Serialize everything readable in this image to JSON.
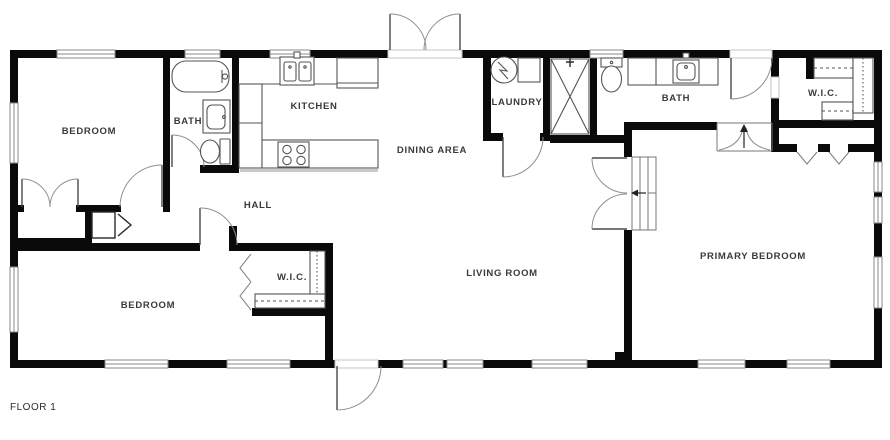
{
  "floor_label": "FLOOR 1",
  "rooms": {
    "bedroom_top_left": {
      "label": "BEDROOM"
    },
    "bath_left": {
      "label": "BATH"
    },
    "kitchen": {
      "label": "KITCHEN"
    },
    "dining": {
      "label": "DINING AREA"
    },
    "laundry": {
      "label": "LAUNDRY"
    },
    "bath_right": {
      "label": "BATH"
    },
    "wic_top_right": {
      "label": "W.I.C."
    },
    "hall": {
      "label": "HALL"
    },
    "bedroom_bottom_left": {
      "label": "BEDROOM"
    },
    "wic_bottom": {
      "label": "W.I.C."
    },
    "living_room": {
      "label": "LIVING ROOM"
    },
    "primary_bedroom": {
      "label": "PRIMARY BEDROOM"
    }
  },
  "fixtures": [
    "bathtub-icon",
    "vanity-sink-icon",
    "toilet-icon",
    "kitchen-sink-icon",
    "fridge-icon",
    "stove-icon",
    "washer-icon",
    "dryer-icon",
    "shower-stall-icon",
    "toilet-icon",
    "vanity-sink-icon",
    "closet-shelf-icon",
    "water-heater-icon"
  ],
  "colors": {
    "wall": "#0a0a0a",
    "fixture_line": "#555555",
    "window_line": "#8a8a8a",
    "door_arc": "#8f8f8f",
    "label_text": "#3a3a3a",
    "background": "#ffffff"
  }
}
